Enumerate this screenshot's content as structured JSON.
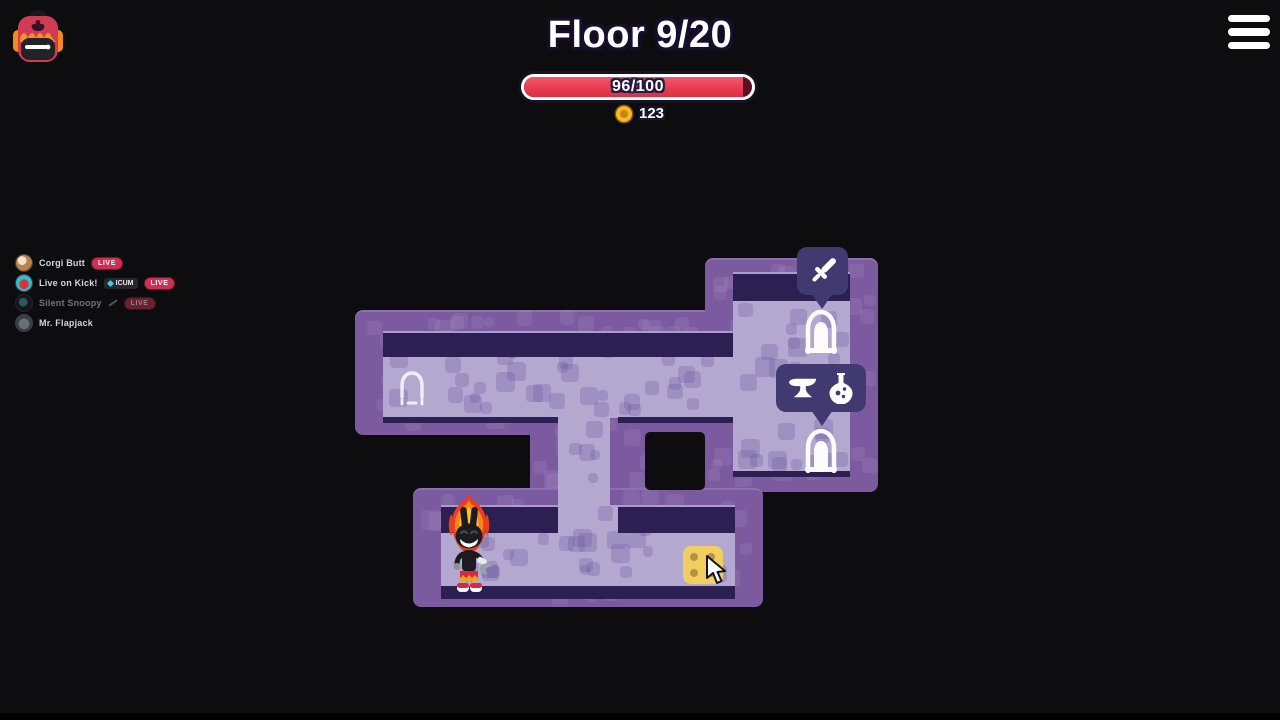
{
  "header": {
    "floor_label": "Floor 9/20",
    "hp": {
      "text": "96/100",
      "current": 96,
      "max": 100,
      "percent": 96
    },
    "coins": "123"
  },
  "labels": {
    "live": "LIVE"
  },
  "streamers": [
    {
      "name": "Corgi Butt",
      "status": "live"
    },
    {
      "name": "Live on Kick!",
      "status": "live",
      "badge": "ICUM"
    },
    {
      "name": "Silent Snoopy",
      "status": "live-faded"
    },
    {
      "name": "Mr. Flapjack",
      "status": "offline"
    }
  ],
  "map": {
    "tooltips": [
      {
        "id": "weapon-room",
        "icons": [
          "sword-icon"
        ]
      },
      {
        "id": "shop-room",
        "icons": [
          "anvil-icon",
          "potion-icon"
        ]
      }
    ],
    "doors": [
      "door-top-right",
      "door-bottom-right",
      "door-left-dim"
    ],
    "items": [
      {
        "id": "cheese-tile",
        "desc": "yellow tile with four holes"
      }
    ],
    "player": {
      "desc": "flaming bunny hero"
    }
  },
  "colors": {
    "background": "#0d0d10",
    "wall": "#7b5aa0",
    "floor": "#b3a9d0",
    "wall_shadow": "#2c2052",
    "tooltip": "#413a70",
    "hp_red": "#e63a4e",
    "coin_gold": "#f6b92a",
    "live_red": "#cf2f52",
    "cheese_yellow": "#f2ce5f"
  }
}
